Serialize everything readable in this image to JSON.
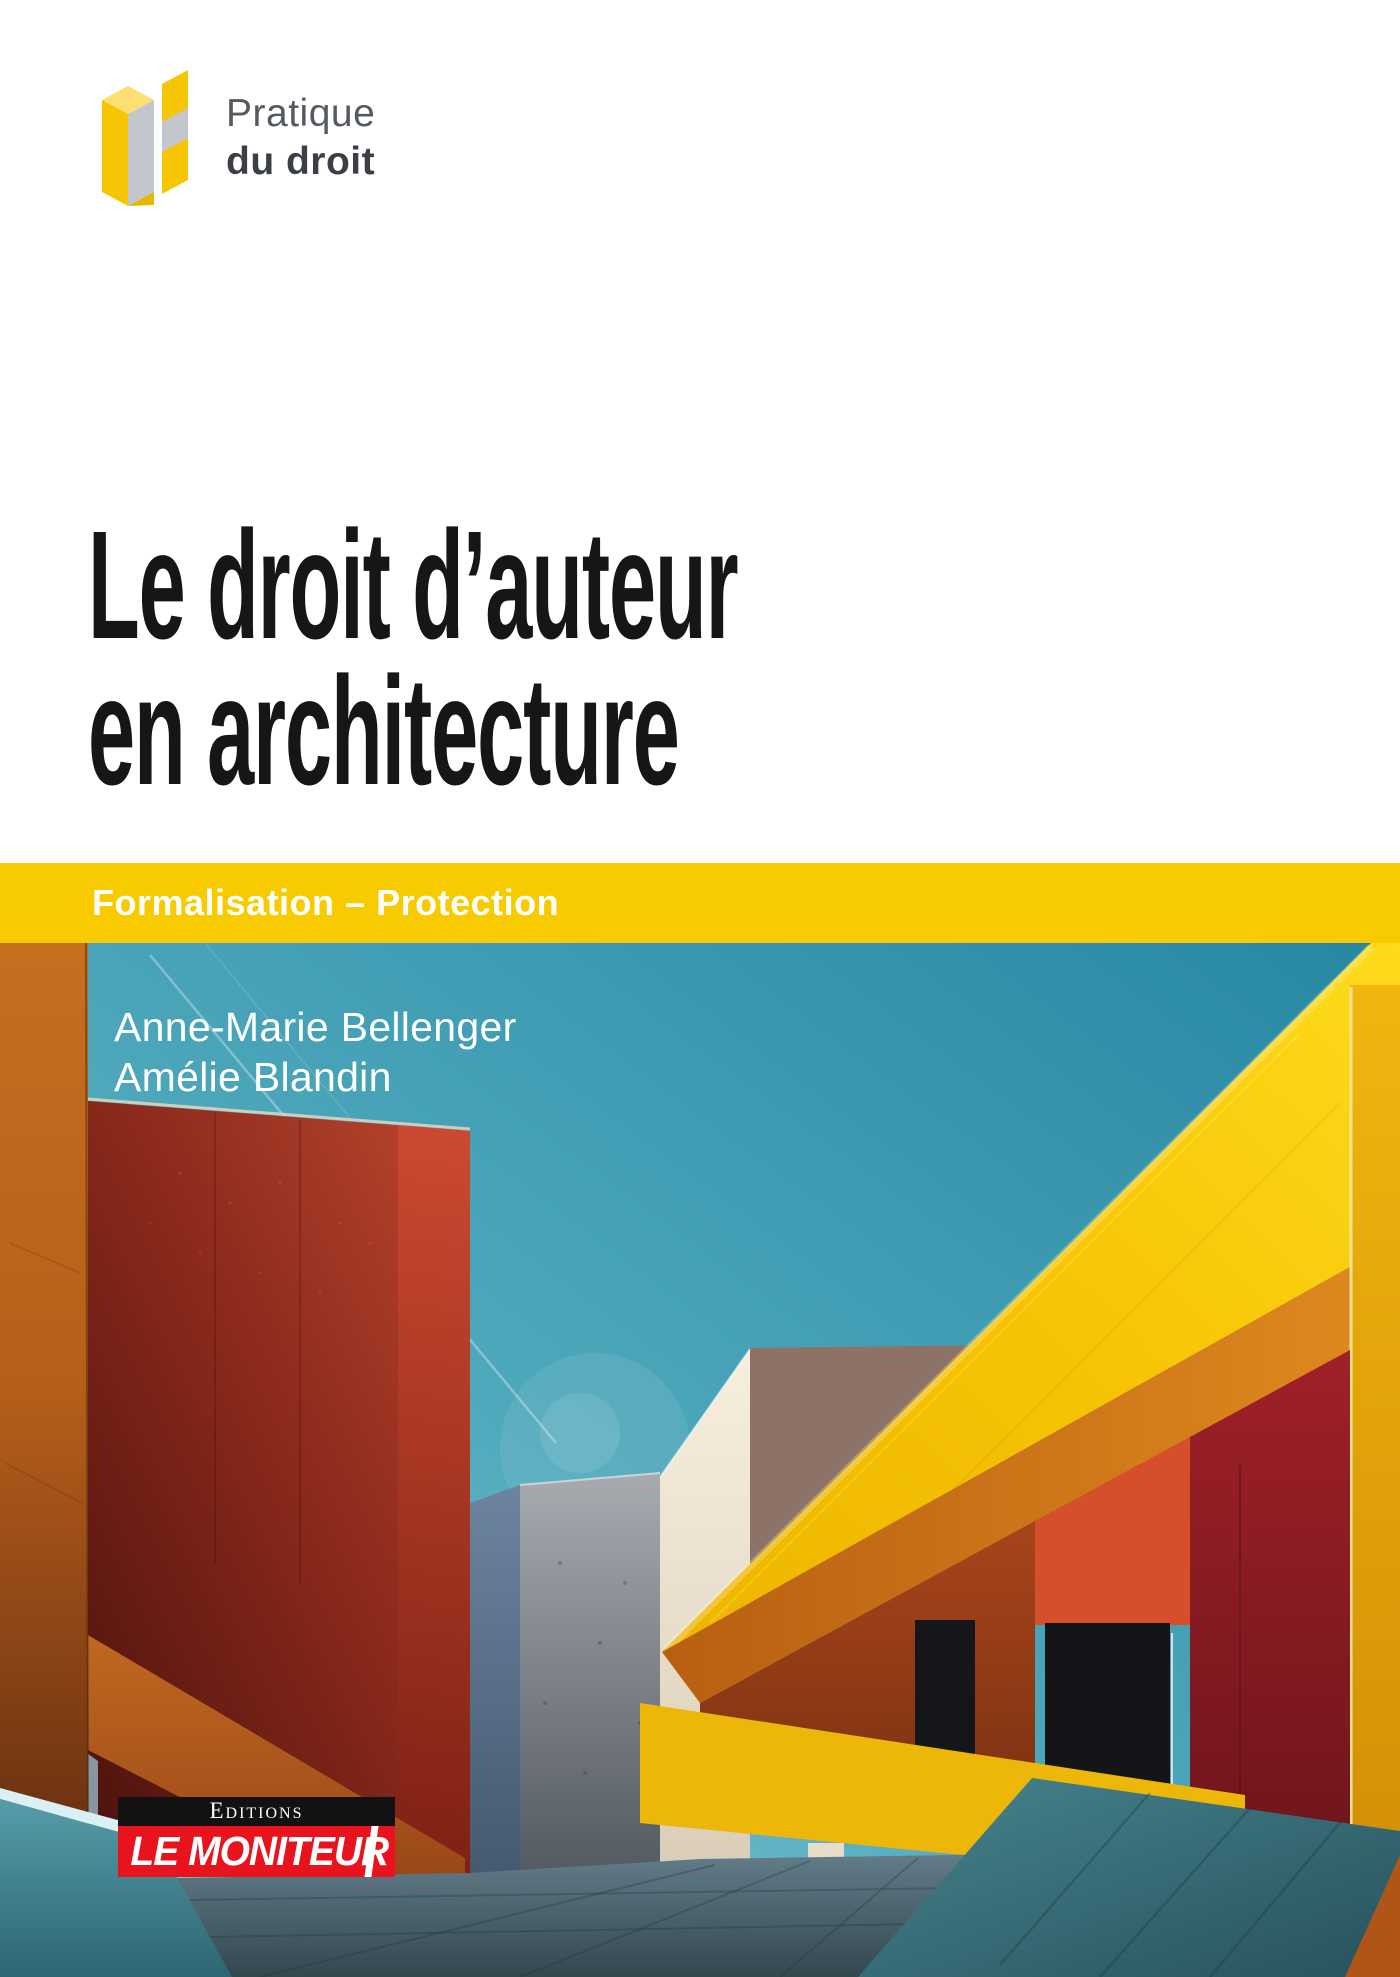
{
  "collection": {
    "line1": "Pratique",
    "line2": "du droit",
    "icon": "isometric-yellow-blocks",
    "yellow": "#f6c503",
    "gray": "#c3c6cc"
  },
  "title": {
    "line1": "Le droit d’auteur",
    "line2": "en architecture"
  },
  "banner": {
    "label": "Formalisation – Protection",
    "background": "#f8ca00",
    "text_color": "#ffffff"
  },
  "authors": [
    "Anne-Marie Bellenger",
    "Amélie Blandin"
  ],
  "publisher": {
    "imprint": "Editions",
    "name": "LE MONITEUR",
    "black": "#121212",
    "red": "#e8131c"
  },
  "photo": {
    "description": "Colorful minimalist architecture under a teal sky: large diagonal yellow beam, dark red and rust buildings, cream and concrete slabs, orange side wall, teal ramp and gray stone pavement",
    "palette": {
      "sky": "#3f9db4",
      "beam_yellow": "#f6c80e",
      "beam_underside": "#d3801d",
      "red_building": "#8c2a1c",
      "orange_wall": "#b5641d",
      "rust_wall": "#a8481c",
      "bright_orange_wall": "#d5502a",
      "dark_red_wall": "#9b2027",
      "cream_building": "#efe5d2",
      "concrete": "#8e939b",
      "teal_ramp": "#3a7683",
      "teal_low_wall": "#4a93a1",
      "pavement": "#516974"
    }
  }
}
